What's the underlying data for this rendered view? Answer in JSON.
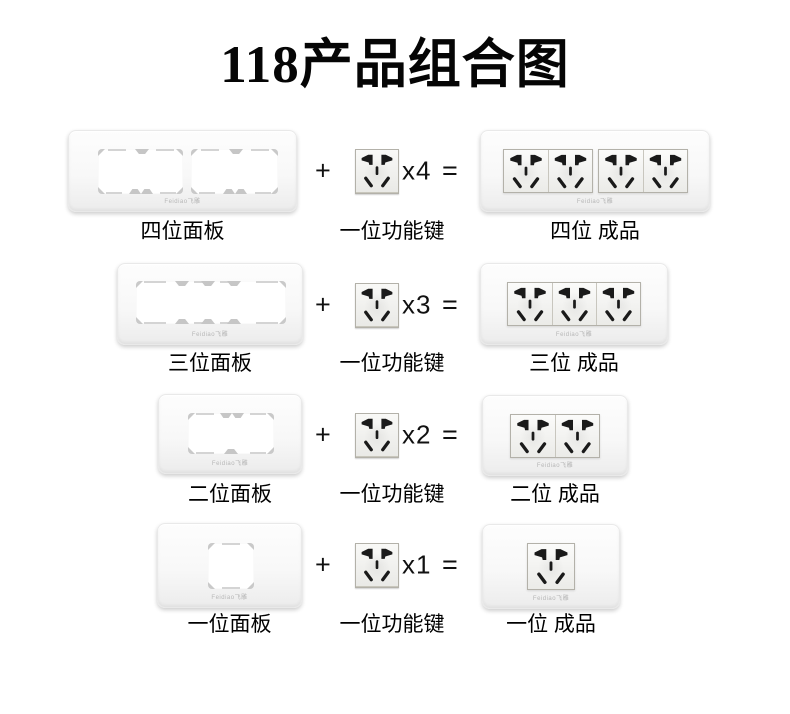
{
  "title": "118产品组合图",
  "brand_mark": "Feidiao飞雕",
  "operators": {
    "plus": "+",
    "equals": "="
  },
  "rows": [
    {
      "panel_label": "四位面板",
      "module_label": "一位功能键",
      "multiplier": "x4",
      "product_label": "四位 成品"
    },
    {
      "panel_label": "三位面板",
      "module_label": "一位功能键",
      "multiplier": "x3",
      "product_label": "三位 成品"
    },
    {
      "panel_label": "二位面板",
      "module_label": "一位功能键",
      "multiplier": "x2",
      "product_label": "二位 成品"
    },
    {
      "panel_label": "一位面板",
      "module_label": "一位功能键",
      "multiplier": "x1",
      "product_label": "一位 成品"
    }
  ],
  "colors": {
    "background": "#ffffff",
    "text": "#000000",
    "socket_hole": "#1a1a1a",
    "panel_face": "#f8f8f8",
    "cutout_mark": "#c6c6c6",
    "socket_border": "#b3b1a9"
  },
  "icons": [
    {
      "name": "socket-five-hole-icon",
      "meaning": "Chinese 5-hole power socket face (2-pin top, 3-pin bottom)"
    }
  ]
}
